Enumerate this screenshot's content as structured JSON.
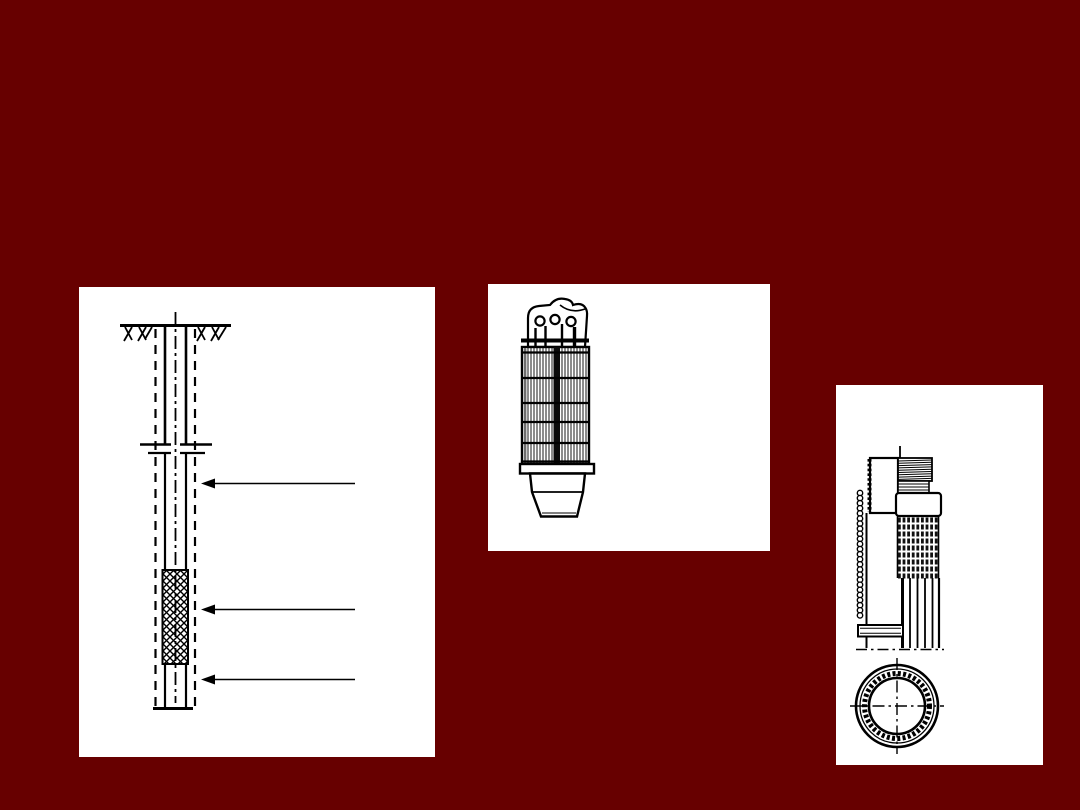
{
  "slide": {
    "background_color": "#670000",
    "panel_color": "#ffffff",
    "ink_color": "#000000"
  },
  "figures": [
    {
      "name": "tube-well-borehole-section",
      "type": "technical-line-drawing",
      "pointer_arrows": 3,
      "elements": [
        "ground-surface-hatch",
        "borehole-dashed-walls",
        "outer-casing-pipe",
        "reducer-coupling",
        "riser-pipe",
        "crosshatched-screen-section",
        "sump-section",
        "vertical-centerline",
        "pointer-arrow-upper",
        "pointer-arrow-middle",
        "pointer-arrow-lower"
      ]
    },
    {
      "name": "well-point-strainer",
      "type": "technical-line-drawing",
      "elements": [
        "top-cap-with-three-holes",
        "lifting-pins",
        "top-clamp-bar",
        "slotted-screen-body",
        "horizontal-band-rings",
        "bottom-collar",
        "tapered-drive-point"
      ]
    },
    {
      "name": "wire-wound-screen-pipe",
      "type": "technical-line-drawing",
      "elements": [
        "threaded-top-nipple",
        "section-cut-cap-block",
        "coupling-collar",
        "wire-wrap-bead-rows",
        "side-wire-bead-strip",
        "vertical-screen-rods",
        "lower-fitting-box",
        "dash-dot-baseline",
        "circular-cross-section-with-bead-ring"
      ]
    }
  ]
}
